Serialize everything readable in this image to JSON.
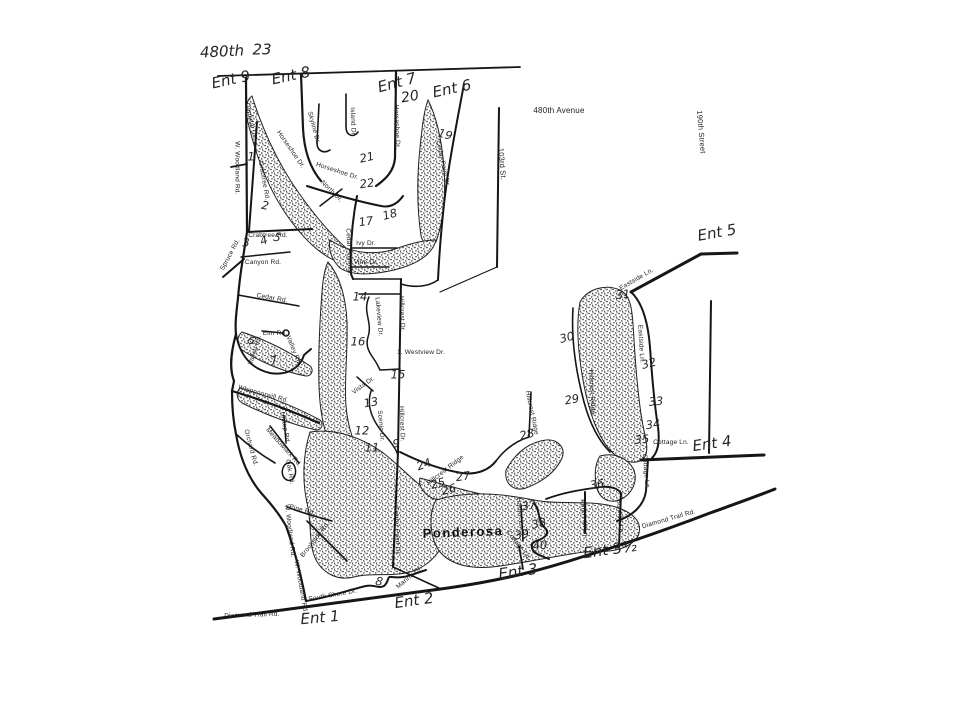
{
  "page": {
    "background": "#ffffff",
    "ink": "#1a1a1a"
  },
  "header": {
    "highway_label": "480th",
    "route_number": "23"
  },
  "lake": {
    "name": "Ponderosa"
  },
  "entrances": [
    {
      "label": "Ent 9",
      "x": 231,
      "y": 80,
      "rot": -12
    },
    {
      "label": "Ent 8",
      "x": 291,
      "y": 76,
      "rot": -12
    },
    {
      "label": "Ent 7",
      "x": 397,
      "y": 83,
      "rot": -15
    },
    {
      "label": "Ent 6",
      "x": 452,
      "y": 89,
      "rot": -12
    },
    {
      "label": "Ent 5",
      "x": 717,
      "y": 233,
      "rot": -10
    },
    {
      "label": "Ent 4",
      "x": 712,
      "y": 444,
      "rot": -8
    },
    {
      "label": "Ent 3½",
      "x": 610,
      "y": 550,
      "rot": -8
    },
    {
      "label": "Ent 3",
      "x": 518,
      "y": 572,
      "rot": -8
    },
    {
      "label": "Ent 2",
      "x": 414,
      "y": 601,
      "rot": -8
    },
    {
      "label": "Ent 1",
      "x": 320,
      "y": 618,
      "rot": -5
    }
  ],
  "lot_numbers": [
    {
      "label": "1",
      "x": 251,
      "y": 157,
      "rot": 0
    },
    {
      "label": "2",
      "x": 265,
      "y": 206,
      "rot": 10
    },
    {
      "label": "3",
      "x": 246,
      "y": 243,
      "rot": 0
    },
    {
      "label": "4",
      "x": 264,
      "y": 241,
      "rot": -20
    },
    {
      "label": "5",
      "x": 277,
      "y": 238,
      "rot": 15
    },
    {
      "label": "6",
      "x": 251,
      "y": 341,
      "rot": 35
    },
    {
      "label": "7",
      "x": 274,
      "y": 361,
      "rot": -15
    },
    {
      "label": "8",
      "x": 379,
      "y": 582,
      "rot": 10
    },
    {
      "label": "19",
      "x": 445,
      "y": 135,
      "rot": 15
    },
    {
      "label": "20",
      "x": 410,
      "y": 97,
      "rot": -10,
      "size": 14
    },
    {
      "label": "21",
      "x": 367,
      "y": 158,
      "rot": -12
    },
    {
      "label": "22",
      "x": 367,
      "y": 184,
      "rot": -8
    },
    {
      "label": "17",
      "x": 366,
      "y": 222,
      "rot": -8
    },
    {
      "label": "18",
      "x": 390,
      "y": 215,
      "rot": -15
    },
    {
      "label": "14",
      "x": 360,
      "y": 297,
      "rot": 0
    },
    {
      "label": "16",
      "x": 358,
      "y": 342,
      "rot": 0
    },
    {
      "label": "15",
      "x": 398,
      "y": 375,
      "rot": 0
    },
    {
      "label": "13",
      "x": 371,
      "y": 403,
      "rot": -10
    },
    {
      "label": "12",
      "x": 362,
      "y": 431,
      "rot": 0
    },
    {
      "label": "11",
      "x": 372,
      "y": 448,
      "rot": 0
    },
    {
      "label": "9",
      "x": 396,
      "y": 444,
      "rot": 0
    },
    {
      "label": "24",
      "x": 424,
      "y": 465,
      "rot": -20
    },
    {
      "label": "25",
      "x": 438,
      "y": 484,
      "rot": -15
    },
    {
      "label": "26",
      "x": 449,
      "y": 490,
      "rot": -15
    },
    {
      "label": "27",
      "x": 463,
      "y": 477,
      "rot": -8
    },
    {
      "label": "28",
      "x": 527,
      "y": 435,
      "rot": -15
    },
    {
      "label": "29",
      "x": 572,
      "y": 400,
      "rot": -10
    },
    {
      "label": "30",
      "x": 567,
      "y": 338,
      "rot": -15
    },
    {
      "label": "31",
      "x": 623,
      "y": 295,
      "rot": -5
    },
    {
      "label": "32",
      "x": 649,
      "y": 364,
      "rot": -15
    },
    {
      "label": "33",
      "x": 656,
      "y": 402,
      "rot": -5
    },
    {
      "label": "34",
      "x": 653,
      "y": 425,
      "rot": -8
    },
    {
      "label": "35",
      "x": 642,
      "y": 440,
      "rot": -5
    },
    {
      "label": "36",
      "x": 597,
      "y": 485,
      "rot": -8
    },
    {
      "label": "37",
      "x": 529,
      "y": 506,
      "rot": -10
    },
    {
      "label": "38",
      "x": 539,
      "y": 524,
      "rot": -12
    },
    {
      "label": "39",
      "x": 522,
      "y": 535,
      "rot": -10
    },
    {
      "label": "40",
      "x": 540,
      "y": 546,
      "rot": -5
    }
  ],
  "road_labels": [
    {
      "label": "W. Woodland Rd.",
      "x": 236,
      "y": 168,
      "rot": 90
    },
    {
      "label": "Cardinal Dr.",
      "x": 250,
      "y": 121,
      "rot": 78
    },
    {
      "label": "Crabtree Rd.",
      "x": 263,
      "y": 181,
      "rot": 80
    },
    {
      "label": "Crabtree Rd.",
      "x": 268,
      "y": 236,
      "rot": 0
    },
    {
      "label": "Spruce Rd.",
      "x": 231,
      "y": 255,
      "rot": -62
    },
    {
      "label": "Canyon Rd.",
      "x": 263,
      "y": 263,
      "rot": 0
    },
    {
      "label": "Cedar Rd.",
      "x": 272,
      "y": 299,
      "rot": 10
    },
    {
      "label": "Elm Rd.",
      "x": 275,
      "y": 334,
      "rot": 0
    },
    {
      "label": "Valley Rd.",
      "x": 256,
      "y": 350,
      "rot": -72
    },
    {
      "label": "Valley Rd.",
      "x": 293,
      "y": 351,
      "rot": 68
    },
    {
      "label": "Whippoorwill Rd.",
      "x": 263,
      "y": 395,
      "rot": 15
    },
    {
      "label": "Hilltop Rd.",
      "x": 284,
      "y": 428,
      "rot": 80
    },
    {
      "label": "Orchard Rd.",
      "x": 250,
      "y": 448,
      "rot": 75
    },
    {
      "label": "Meadowlark Rd.",
      "x": 283,
      "y": 448,
      "rot": 48
    },
    {
      "label": "Oak Rd.",
      "x": 289,
      "y": 472,
      "rot": 80
    },
    {
      "label": "Pine Rd.",
      "x": 302,
      "y": 511,
      "rot": 15
    },
    {
      "label": "W. Woodland Rd.",
      "x": 289,
      "y": 531,
      "rot": 83
    },
    {
      "label": "Brookside Rd.",
      "x": 316,
      "y": 540,
      "rot": -52
    },
    {
      "label": "W. Woodland Rd.",
      "x": 300,
      "y": 587,
      "rot": 80
    },
    {
      "label": "South Shore Dr.",
      "x": 333,
      "y": 596,
      "rot": -10
    },
    {
      "label": "Diamond Trail Rd.",
      "x": 252,
      "y": 616,
      "rot": -2
    },
    {
      "label": "Marina Dr.",
      "x": 410,
      "y": 578,
      "rot": -40
    },
    {
      "label": "Center Point Dr.",
      "x": 396,
      "y": 531,
      "rot": 88
    },
    {
      "label": "Horseshoe Dr.",
      "x": 290,
      "y": 150,
      "rot": 55
    },
    {
      "label": "Skyline Dr.",
      "x": 313,
      "y": 128,
      "rot": 75
    },
    {
      "label": "Island Dr.",
      "x": 352,
      "y": 122,
      "rot": 88
    },
    {
      "label": "Horseshoe Dr.",
      "x": 396,
      "y": 127,
      "rot": 88
    },
    {
      "label": "Horseshoe Dr.",
      "x": 337,
      "y": 172,
      "rot": 18
    },
    {
      "label": "North Dr.",
      "x": 331,
      "y": 192,
      "rot": 45
    },
    {
      "label": "Cedar Point Dr.",
      "x": 442,
      "y": 164,
      "rot": 78
    },
    {
      "label": "Cedar Point Dr.",
      "x": 348,
      "y": 252,
      "rot": 88
    },
    {
      "label": "Ivy Dr.",
      "x": 366,
      "y": 244,
      "rot": 0
    },
    {
      "label": "Vine Dr.",
      "x": 366,
      "y": 263,
      "rot": 0
    },
    {
      "label": "Lakeview Dr.",
      "x": 378,
      "y": 317,
      "rot": 85
    },
    {
      "label": "Hillcrest Dr.",
      "x": 401,
      "y": 314,
      "rot": 88
    },
    {
      "label": "1. Westview Dr.",
      "x": 421,
      "y": 353,
      "rot": 0
    },
    {
      "label": "Vista Dr.",
      "x": 364,
      "y": 386,
      "rot": -36
    },
    {
      "label": "Scenic Dr.",
      "x": 380,
      "y": 426,
      "rot": 85
    },
    {
      "label": "Hillcrest Dr.",
      "x": 401,
      "y": 424,
      "rot": 88
    },
    {
      "label": "Hillcrest Ridge",
      "x": 446,
      "y": 471,
      "rot": -38
    },
    {
      "label": "Hillcrest Ridge",
      "x": 531,
      "y": 413,
      "rot": 78
    },
    {
      "label": "Hillcrest Ridge",
      "x": 591,
      "y": 392,
      "rot": 87
    },
    {
      "label": "Eastside Ln.",
      "x": 637,
      "y": 280,
      "rot": -30
    },
    {
      "label": "Eastside Ln.",
      "x": 640,
      "y": 344,
      "rot": 87
    },
    {
      "label": "Cottage Ln.",
      "x": 671,
      "y": 443,
      "rot": 0
    },
    {
      "label": "Cottage Ln.",
      "x": 645,
      "y": 472,
      "rot": 85
    },
    {
      "label": "Cottage Ln.",
      "x": 518,
      "y": 546,
      "rot": 52
    },
    {
      "label": "Harbor Ln.",
      "x": 519,
      "y": 514,
      "rot": 85
    },
    {
      "label": "Knob Hill Ln.",
      "x": 583,
      "y": 519,
      "rot": 85
    },
    {
      "label": "Sunrise Ln.",
      "x": 619,
      "y": 517,
      "rot": 85
    },
    {
      "label": "Diamond Trail Rd.",
      "x": 669,
      "y": 520,
      "rot": -16
    },
    {
      "label": "480th Avenue",
      "x": 559,
      "y": 111,
      "rot": 0,
      "size": 8
    },
    {
      "label": "103rd St.",
      "x": 502,
      "y": 164,
      "rot": 85,
      "size": 7.5
    },
    {
      "label": "190th Street",
      "x": 701,
      "y": 132,
      "rot": 85,
      "size": 7.5
    }
  ]
}
